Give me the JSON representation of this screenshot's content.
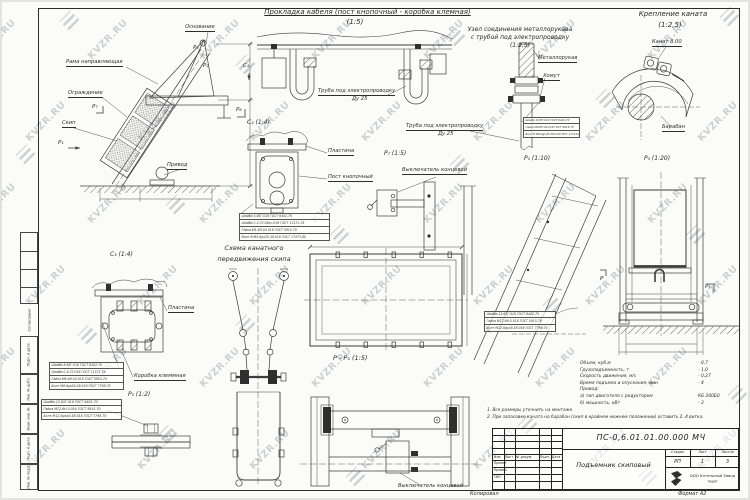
{
  "watermark": {
    "text": "KVZR.RU"
  },
  "header_titles": {
    "cable_title": "Прокладка кабеля (пост кнопочный - коробка клемная)",
    "cable_scale": "(1:5)",
    "rope_title": "Крепление каната",
    "rope_scale": "(1:2,5)",
    "node_title_line1": "Узел соединения металлорукава",
    "node_title_line2": "с трубой под электропроводку",
    "node_scale": "(1:2,5)"
  },
  "main_view": {
    "labels": {
      "base": "Основание",
      "guide_frame": "Рама направляющая",
      "guard": "Ограждение",
      "skip": "Скип",
      "drive": "Привод"
    },
    "marks": {
      "p1": "Р₁",
      "p2": "Р₂",
      "p4": "Р₄",
      "p6": "Р₆",
      "p7": "Р₇",
      "c4": "С₄"
    }
  },
  "cable_view": {
    "pipe_label": "Труба под электропроводку",
    "pipe_dn": "Ду 25"
  },
  "node_view": {
    "hose": "Металлорукав",
    "clamp": "Хомут",
    "pipe_label": "Труба под электропроводку",
    "pipe_dn": "Ду 25",
    "hw": [
      "Шайба 6.65Г.016 ГОСТ 6402-70",
      "Гайка М6-6Н.04.016 ГОСТ 5915-70",
      "Винт В.М6-6gх25.58.016 ГОСТ 17473-80"
    ]
  },
  "rope_view": {
    "rope": "Канат 8.00",
    "drum": "Барабан"
  },
  "c2_view": {
    "label": "С₂ (1:4)",
    "plate": "Пластина",
    "button_post": "Пост кнопочный",
    "hw": [
      "Шайба 5.65Г.016 ГОСТ 6402-70",
      "Шайба С.5.37.08кп.016 ГОСТ 11371-78",
      "Гайка М5-6Н.04.016 ГОСТ 5915-70",
      "Винт В.М5-6gх20.58.016 ГОСТ 17473-80"
    ]
  },
  "scheme": {
    "title_line1": "Схема канатного",
    "title_line2": "передвижения скипа"
  },
  "c3_view": {
    "label": "С₃ (1:4)",
    "plate": "Пластина",
    "terminal_box": "Коробка клеммная",
    "hw": [
      "Шайба 8.65Г.016 ГОСТ 6402-70",
      "Шайба С.8.37.016 ГОСТ 11371-78",
      "Гайка М8-6Н.04.016 ГОСТ 5915-70",
      "Болт М8-6gх50.58.016 ГОСТ 7798-70"
    ]
  },
  "r5_view": {
    "label": "Р₅ (1:2)",
    "hw": [
      "Шайба 12.65Г.016 ГОСТ 6402-70",
      "Гайка М12-6Н.5.016 ГОСТ 5915-70",
      "Болт М12-6gх40.58.016 ГОСТ 7798-70"
    ]
  },
  "r7_view": {
    "label": "Р₇ (1:5)",
    "limit_switch": "Выключатель концевой"
  },
  "r1_view": {
    "label": "Р₁ (1:10)",
    "hw": [
      "Шайба 12.65Г.016 ГОСТ 6402-70",
      "Гайка М12-6Н.5.016 ГОСТ 5915-70",
      "Болт М12-6gх40.58.016 ГОСТ 7798-70"
    ]
  },
  "r3_view": {
    "label": "Р₃ (1:20)",
    "mark_p": "Р",
    "mark_p5": "Р₅"
  },
  "pp5_view": {
    "label": "Р - Р₅ (1:5)"
  },
  "bottom_view": {
    "limit_switch": "Выключатель концевой"
  },
  "specs": {
    "rows": [
      {
        "label": "Объем, куб.м",
        "value": "- 0,7"
      },
      {
        "label": "Грузоподъемность, т",
        "value": "- 1,0"
      },
      {
        "label": "Скорость движения, м/с",
        "value": "- 0,27"
      },
      {
        "label": "Время подъема и опускания, мин",
        "value": "- 4"
      },
      {
        "label": "Привод:",
        "value": ""
      },
      {
        "label": "а) тип двигателя с редуктором",
        "value": "КБ 200Б0"
      },
      {
        "label": "б) мощность, кВт",
        "value": "- 3"
      }
    ]
  },
  "notes": {
    "line1": "1. Все размеры уточнить на монтаже.",
    "line2": "2. При запасовке каната на барабан (скип в крайнем нижнем положении) оставить 2..4 витка."
  },
  "title_block": {
    "doc_number": "ПС-0,6.01.01.00.000 МЧ",
    "doc_title": "Подъемник скиповый",
    "col_headers": [
      "Изм.",
      "Лист",
      "№ докум.",
      "Подп.",
      "Дата"
    ],
    "row_labels": [
      "Проект",
      "Провер.",
      "ГИП"
    ],
    "stage_label": "Стадия",
    "sheet_label": "Лист",
    "sheets_label": "Листов",
    "stage": "РП",
    "sheet": "1",
    "sheets": "3",
    "company_line1": "ООО Котельный Завод",
    "company_line2": "\"РЭП\"",
    "copied": "Копировал",
    "format": "Формат А2"
  },
  "side_strip": {
    "items": [
      "Согласовано",
      "Подп. и дата",
      "Инв. № дубл.",
      "Взам. инв. №",
      "Подп. и дата",
      "Инв. № подл."
    ]
  }
}
